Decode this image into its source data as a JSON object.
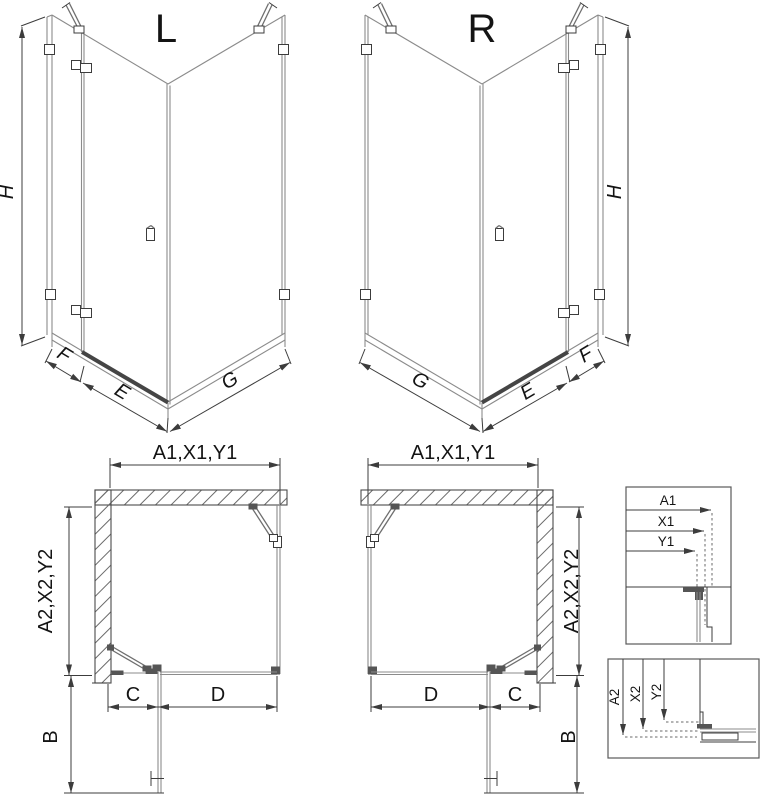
{
  "iso_views": {
    "left_letter": "L",
    "right_letter": "R",
    "height_label": "H",
    "fixed_width_label": "F",
    "door_width_label": "E",
    "side_panel_label": "G"
  },
  "plan_views": {
    "top_dim_label": "A1,X1,Y1",
    "side_dim_label": "A2,X2,Y2",
    "opening_label": "C",
    "fixed_glass_label": "D",
    "door_panel_label": "B"
  },
  "detail_boxes": {
    "horizontal": {
      "a1": "A1",
      "x1": "X1",
      "y1": "Y1"
    },
    "vertical": {
      "a2": "A2",
      "x2": "X2",
      "y2": "Y2"
    }
  },
  "colors": {
    "line": "#3c3c3c",
    "glass": "#8b8b8b",
    "dark_fill": "#555555",
    "text": "#141414",
    "background": "#ffffff"
  }
}
